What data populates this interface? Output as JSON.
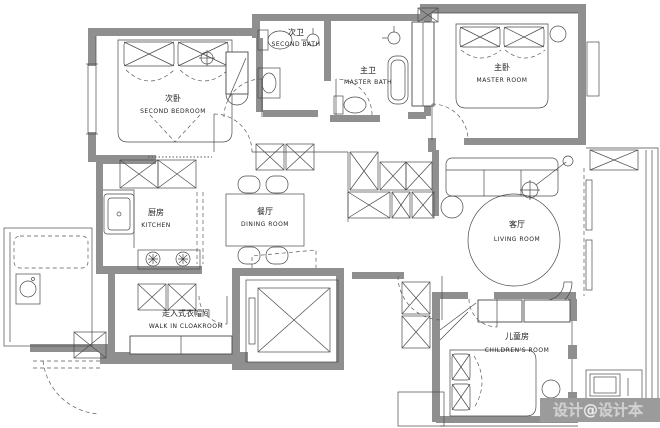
{
  "rooms": {
    "second_bedroom": {
      "cn": "次卧",
      "en": "SECOND BEDROOM"
    },
    "second_bath": {
      "cn": "次卫",
      "en": "SECOND BATH"
    },
    "master_bath": {
      "cn": "主卫",
      "en": "MASTER BATH"
    },
    "master_room": {
      "cn": "主卧",
      "en": "MASTER ROOM"
    },
    "kitchen": {
      "cn": "厨房",
      "en": "KITCHEN"
    },
    "dining_room": {
      "cn": "餐厅",
      "en": "DINING ROOM"
    },
    "living_room": {
      "cn": "客厅",
      "en": "LIVING ROOM"
    },
    "walk_in_cloakroom": {
      "cn": "走入式衣帽间",
      "en": "WALK IN CLOAKROOM"
    },
    "childrens_room": {
      "cn": "儿童房",
      "en": "CHILDREN'S ROOM"
    }
  },
  "watermark": "设计@设计本",
  "colors": {
    "wall": "#8f8f8f",
    "line": "#3b3b3b",
    "background": "#ffffff",
    "watermark_band": "#9b9b9b"
  }
}
